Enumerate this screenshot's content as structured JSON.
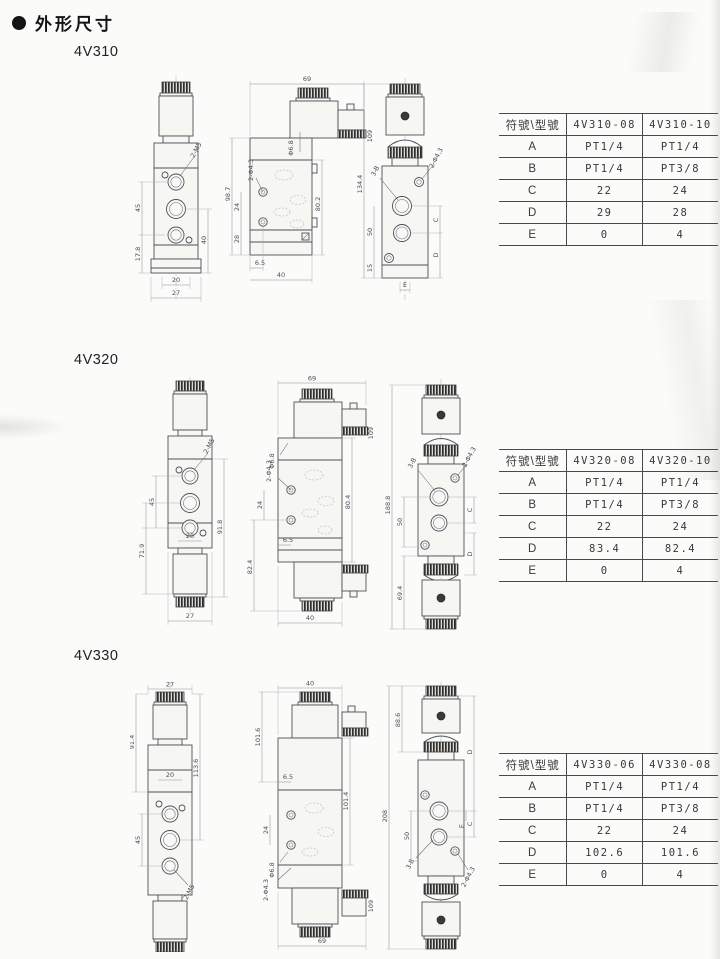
{
  "page": {
    "bullet": "●",
    "title": "外形尺寸"
  },
  "sections": [
    {
      "label": "4V310",
      "table": {
        "header": [
          "符號\\型號",
          "4V310-08",
          "4V310-10"
        ],
        "rows": [
          [
            "A",
            "PT1/4",
            "PT1/4"
          ],
          [
            "B",
            "PT1/4",
            "PT3/8"
          ],
          [
            "C",
            "22",
            "24"
          ],
          [
            "D",
            "29",
            "28"
          ],
          [
            "E",
            "0",
            "4"
          ]
        ]
      },
      "views": {
        "front": {
          "thread": "2-M5",
          "v1": "45",
          "v2": "17.8",
          "v3": "40",
          "w1": "20",
          "w2": "27"
        },
        "side": {
          "top": "69",
          "hole": "Φ6.8",
          "mount": "2-Φ4.3",
          "v1": "98.7",
          "v2": "24",
          "v3": "28",
          "v4": "80.2",
          "conn": "109",
          "w1": "6.5",
          "w2": "40"
        },
        "profile": {
          "total": "134.4",
          "ports": "3-B",
          "mount": "2-Φ4.3",
          "v1": "50",
          "v2": "15",
          "c": "C",
          "d": "D",
          "e": "E"
        }
      }
    },
    {
      "label": "4V320",
      "table": {
        "header": [
          "符號\\型號",
          "4V320-08",
          "4V320-10"
        ],
        "rows": [
          [
            "A",
            "PT1/4",
            "PT1/4"
          ],
          [
            "B",
            "PT1/4",
            "PT3/8"
          ],
          [
            "C",
            "22",
            "24"
          ],
          [
            "D",
            "83.4",
            "82.4"
          ],
          [
            "E",
            "0",
            "4"
          ]
        ]
      },
      "views": {
        "front": {
          "thread": "2-M5",
          "v1": "45",
          "v2": "71.9",
          "v3": "91.8",
          "w1": "20",
          "w2": "27"
        },
        "side": {
          "top": "69",
          "hole": "Φ6.8",
          "mount": "2-Φ4.3",
          "v1": "24",
          "v2": "80.4",
          "v3": "82.4",
          "conn": "109",
          "w1": "6.5",
          "w2": "40"
        },
        "profile": {
          "total": "188.8",
          "ports": "3-B",
          "mount": "2-Φ4.3",
          "v1": "50",
          "v2": "69.4",
          "c": "C",
          "d": "D"
        }
      }
    },
    {
      "label": "4V330",
      "table": {
        "header": [
          "符號\\型號",
          "4V330-06",
          "4V330-08"
        ],
        "rows": [
          [
            "A",
            "PT1/4",
            "PT1/4"
          ],
          [
            "B",
            "PT1/4",
            "PT3/8"
          ],
          [
            "C",
            "22",
            "24"
          ],
          [
            "D",
            "102.6",
            "101.6"
          ],
          [
            "E",
            "0",
            "4"
          ]
        ]
      },
      "views": {
        "front": {
          "thread": "2-M5",
          "top": "27",
          "v1": "91.4",
          "v2": "113.6",
          "v3": "45",
          "w1": "20"
        },
        "side": {
          "top": "40",
          "hole": "Φ6.8",
          "mount": "2-Φ4.3",
          "v1": "101.6",
          "v2": "6.5",
          "v3": "24",
          "v4": "101.4",
          "conn": "109",
          "w1": "69"
        },
        "profile": {
          "total": "208",
          "v1": "88.6",
          "v2": "50",
          "ports": "3-B",
          "mount": "2-Φ4.3",
          "c": "C",
          "d": "D",
          "e": "E"
        }
      }
    }
  ]
}
